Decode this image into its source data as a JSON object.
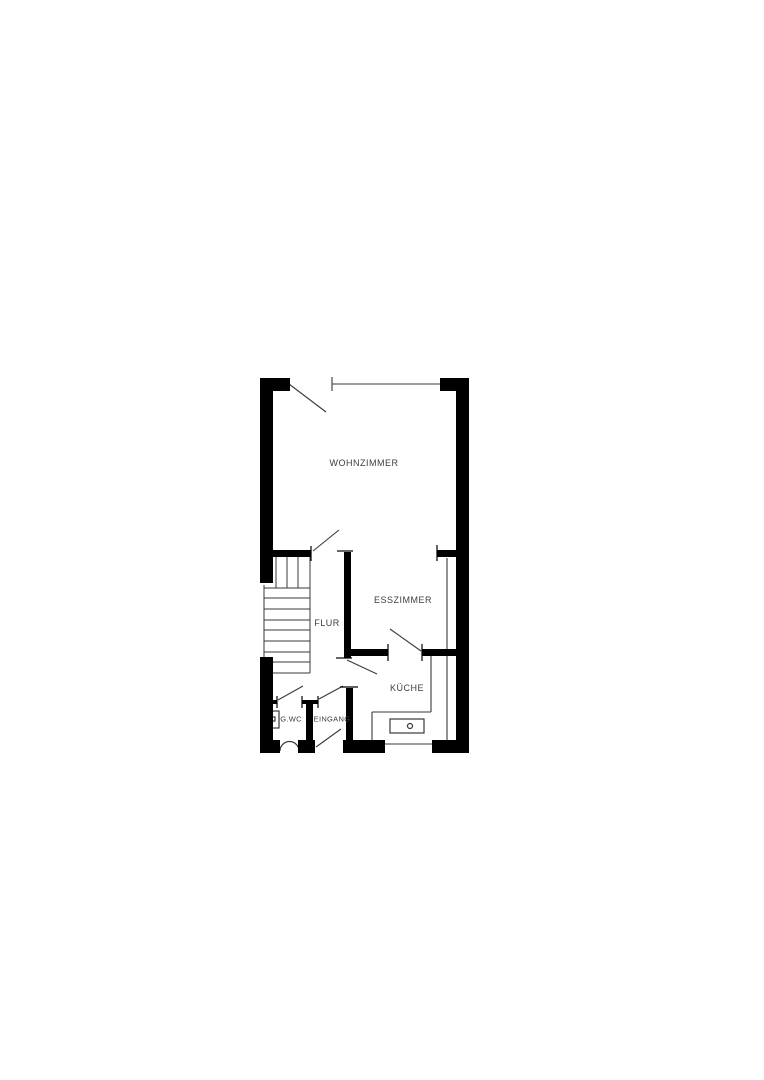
{
  "floorplan": {
    "rooms": {
      "wohnzimmer": {
        "label": "WOHNZIMMER"
      },
      "esszimmer": {
        "label": "ESSZIMMER"
      },
      "flur": {
        "label": "FLUR"
      },
      "kueche": {
        "label": "KÜCHE"
      },
      "gwc": {
        "label": "G.WC"
      },
      "eingang": {
        "label": "EINGANG"
      }
    },
    "colors": {
      "wall": "#000000",
      "line": "#3a3a3a",
      "text": "#3d3d3d",
      "background": "#ffffff"
    }
  }
}
